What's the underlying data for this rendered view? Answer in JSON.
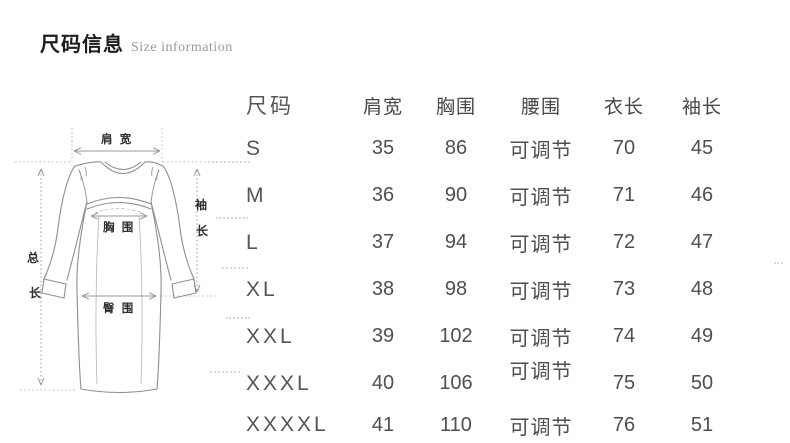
{
  "header": {
    "title_zh": "尺码信息",
    "title_en": "Size information"
  },
  "diagram": {
    "labels": {
      "shoulder": "肩 宽",
      "bust": "胸 围",
      "hip": "臀 围",
      "sleeve_1": "袖",
      "sleeve_2": "长",
      "total_1": "总",
      "total_2": "长"
    }
  },
  "size_table": {
    "columns": [
      "尺码",
      "肩宽",
      "胸围",
      "腰围",
      "衣长",
      "袖长"
    ],
    "rows": [
      {
        "size": "S",
        "shoulder": "35",
        "bust": "86",
        "waist": "可调节",
        "length": "70",
        "sleeve": "45"
      },
      {
        "size": "M",
        "shoulder": "36",
        "bust": "90",
        "waist": "可调节",
        "length": "71",
        "sleeve": "46"
      },
      {
        "size": "L",
        "shoulder": "37",
        "bust": "94",
        "waist": "可调节",
        "length": "72",
        "sleeve": "47"
      },
      {
        "size": "XL",
        "shoulder": "38",
        "bust": "98",
        "waist": "可调节",
        "length": "73",
        "sleeve": "48"
      },
      {
        "size": "XXL",
        "shoulder": "39",
        "bust": "102",
        "waist": "可调节",
        "length": "74",
        "sleeve": "49"
      },
      {
        "size": "XXXL",
        "shoulder": "40",
        "bust": "106",
        "waist": "可调节",
        "length": "75",
        "sleeve": "50"
      },
      {
        "size": "XXXXL",
        "shoulder": "41",
        "bust": "110",
        "waist": "可调节",
        "length": "76",
        "sleeve": "51"
      }
    ]
  },
  "colors": {
    "title_text": "#1d1d1d",
    "subtitle_text": "#9a9a9a",
    "table_text": "#4f4f4f",
    "line_art": "#8f8f8f",
    "dotted_guide": "#b8b8b8"
  }
}
